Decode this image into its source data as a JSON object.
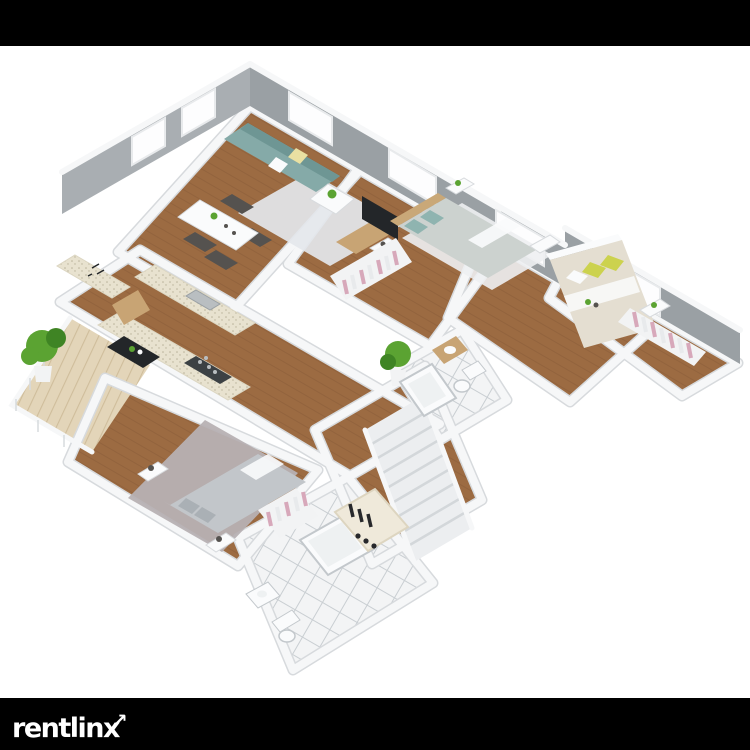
{
  "window": {
    "width": 750,
    "height": 750,
    "background": "#ffffff"
  },
  "bars": {
    "top_color": "#000000",
    "bottom_color": "#000000"
  },
  "logo": {
    "text": "rentlinx",
    "arrow_icon": "↗",
    "color": "#ffffff"
  },
  "floorplan": {
    "type": "isometric-3d-apartment-floor-plan",
    "background": "#ffffff",
    "palette": {
      "wallFace": "#9aa0a4",
      "wallFaceLight": "#a9aeb2",
      "wallTop": "#f6f7f8",
      "wallShadow": "#d7dadd",
      "windowWhite": "#fdfdfe",
      "windowFrame": "#e8eaec",
      "wood": "#9c6b42",
      "woodDark": "#8a5c38",
      "tile": "#f3f4f5",
      "tileLine": "#c9ced2",
      "deck": "#e3d5b9",
      "deckLine": "#cfbd9b",
      "rugLight": "#e4e7ec",
      "rugWhite": "#eef0f2",
      "rugGray": "#b7b1b3",
      "sofa": "#85aaa8",
      "sofaDark": "#6e9694",
      "pillowYellow": "#e9e0a2",
      "white": "#fafbfc",
      "tableWood": "#c8a474",
      "chairDark": "#55524f",
      "counter": "#e8e2cf",
      "counterDot": "#b9b29a",
      "steel": "#b9bec1",
      "stove": "#3c4144",
      "fridge": "#232629",
      "bedGray": "#ccd2cf",
      "bedTeal": "#8fb4b0",
      "bedCream": "#e4ded1",
      "pillowGreen": "#ccd24e",
      "bed3Gray": "#c2c6ca",
      "headboard": "#c9a878",
      "clothesPink": "#d7a8ba",
      "clothesWhite": "#e8eaec",
      "clothesDark": "#27282b",
      "plant": "#5ba332",
      "plantDark": "#3f8424",
      "pot": "#f2f3f4",
      "stairs": "#eceef0",
      "stairShadow": "#d3d7da",
      "fixtureLine": "#c3c8cc",
      "wardrobe": "#efe9da"
    },
    "rooms": [
      {
        "name": "living-room",
        "furniture": [
          "teal sofa",
          "yellow pillow",
          "white pillow",
          "coffee table",
          "area rug",
          "tv",
          "tv console"
        ]
      },
      {
        "name": "dining-area",
        "furniture": [
          "white dining table",
          "four chairs",
          "table plant"
        ]
      },
      {
        "name": "kitchen",
        "furniture": [
          "speckled counters",
          "sink",
          "stove",
          "open refrigerator"
        ]
      },
      {
        "name": "entry",
        "furniture": [
          "console counter",
          "open wood door"
        ]
      },
      {
        "name": "balcony",
        "furniture": [
          "wood deck",
          "railing",
          "large plant"
        ]
      },
      {
        "name": "bedroom-1",
        "furniture": [
          "double bed teal pillows",
          "headboard",
          "two nightstands",
          "closet with clothes",
          "white rug",
          "floor plant"
        ]
      },
      {
        "name": "bedroom-2",
        "furniture": [
          "double bed yellow pillows",
          "two nightstands",
          "flowers"
        ]
      },
      {
        "name": "walk-in-closet",
        "furniture": [
          "hanging clothes"
        ]
      },
      {
        "name": "bedroom-3",
        "furniture": [
          "gray double bed",
          "two nightstands with lamps",
          "gray shag rug"
        ]
      },
      {
        "name": "ensuite-bathroom",
        "furniture": [
          "bathtub",
          "toilet",
          "wood vanity"
        ]
      },
      {
        "name": "main-bathroom",
        "furniture": [
          "bathtub",
          "toilet",
          "sink",
          "closet with clothes"
        ]
      },
      {
        "name": "hallway",
        "furniture": [
          "open wardrobe with dark clothes",
          "boots"
        ]
      },
      {
        "name": "staircase",
        "furniture": [
          "white stairs",
          "railing"
        ]
      }
    ]
  }
}
